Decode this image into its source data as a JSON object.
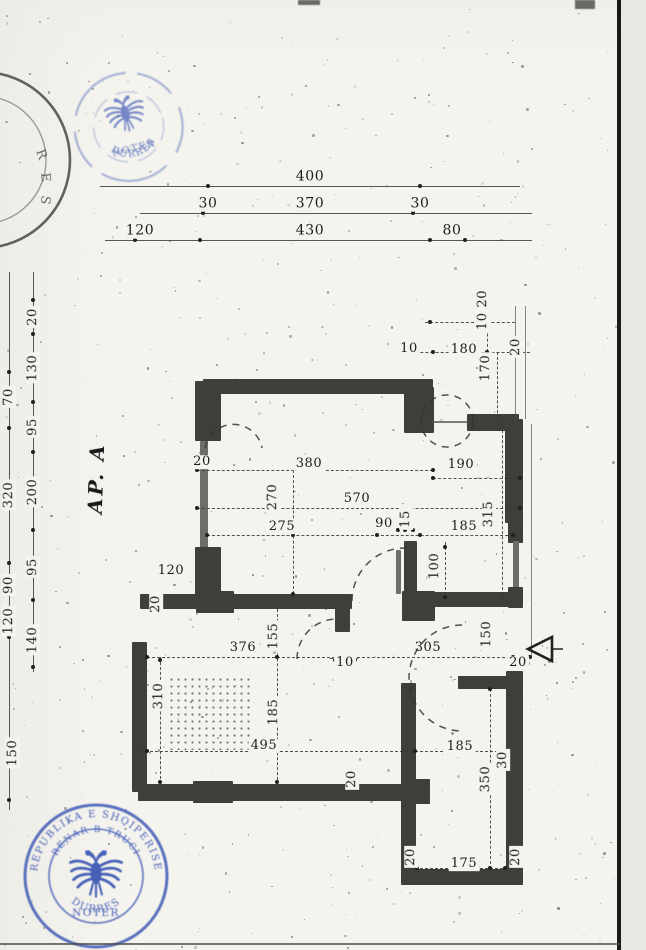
{
  "document": {
    "kind": "scanned notarized architectural floor plan",
    "apartment_label": "AP. A"
  },
  "colors": {
    "paper": "#f4f3ee",
    "ink": "#22211e",
    "wall": "#3f3e3b",
    "stamp_blue": "#3a55b4"
  },
  "stamps": {
    "top_round": {
      "line1": "NOTER",
      "line2": "DURRES"
    },
    "left_partial": {
      "letters": [
        "R",
        "E",
        "S"
      ]
    },
    "bottom_round": {
      "outer_text": "REPUBLIKA E SHQIPERISE",
      "mid_text": "RENAR B TRUCI",
      "line1": "NOTER",
      "line2": "DURRES"
    }
  },
  "dims": [
    {
      "id": "t400",
      "text": "400",
      "group": "top-row1"
    },
    {
      "id": "t30a",
      "text": "30",
      "group": "top-row2"
    },
    {
      "id": "t370",
      "text": "370",
      "group": "top-row2"
    },
    {
      "id": "t30b",
      "text": "30",
      "group": "top-row2"
    },
    {
      "id": "t120",
      "text": "120",
      "group": "top-row3"
    },
    {
      "id": "t430",
      "text": "430",
      "group": "top-row3"
    },
    {
      "id": "t80",
      "text": "80",
      "group": "top-row3"
    },
    {
      "id": "li20",
      "text": "20",
      "group": "left-inner"
    },
    {
      "id": "li130",
      "text": "130",
      "group": "left-inner"
    },
    {
      "id": "li95a",
      "text": "95",
      "group": "left-inner"
    },
    {
      "id": "li200",
      "text": "200",
      "group": "left-inner"
    },
    {
      "id": "li95b",
      "text": "95",
      "group": "left-inner"
    },
    {
      "id": "li140",
      "text": "140",
      "group": "left-inner"
    },
    {
      "id": "lo70",
      "text": "70",
      "group": "left-outer"
    },
    {
      "id": "lo320",
      "text": "320",
      "group": "left-outer"
    },
    {
      "id": "lo90",
      "text": "90",
      "group": "left-outer"
    },
    {
      "id": "lo120",
      "text": "120",
      "group": "left-outer"
    },
    {
      "id": "lo150",
      "text": "150",
      "group": "left-outer"
    },
    {
      "id": "d20a",
      "text": "20",
      "group": "plan"
    },
    {
      "id": "d380",
      "text": "380",
      "group": "plan"
    },
    {
      "id": "d570",
      "text": "570",
      "group": "plan"
    },
    {
      "id": "d270",
      "text": "270",
      "group": "plan"
    },
    {
      "id": "d275",
      "text": "275",
      "group": "plan"
    },
    {
      "id": "d90",
      "text": "90",
      "group": "plan"
    },
    {
      "id": "d15",
      "text": "15",
      "group": "plan"
    },
    {
      "id": "d185a",
      "text": "185",
      "group": "plan"
    },
    {
      "id": "d190",
      "text": "190",
      "group": "plan"
    },
    {
      "id": "d315",
      "text": "315",
      "group": "plan"
    },
    {
      "id": "d180",
      "text": "180",
      "group": "plan"
    },
    {
      "id": "d170",
      "text": "170",
      "group": "plan"
    },
    {
      "id": "d10a",
      "text": "10",
      "group": "plan"
    },
    {
      "id": "d1020",
      "text": "10 20",
      "group": "plan"
    },
    {
      "id": "d20b",
      "text": "20",
      "group": "plan"
    },
    {
      "id": "d100",
      "text": "100",
      "group": "plan"
    },
    {
      "id": "d20c",
      "text": "20",
      "group": "plan"
    },
    {
      "id": "d120b",
      "text": "120",
      "group": "plan"
    },
    {
      "id": "d376",
      "text": "376",
      "group": "plan"
    },
    {
      "id": "d155",
      "text": "155",
      "group": "plan"
    },
    {
      "id": "d10b",
      "text": "10",
      "group": "plan"
    },
    {
      "id": "d305",
      "text": "305",
      "group": "plan"
    },
    {
      "id": "d150b",
      "text": "150",
      "group": "plan"
    },
    {
      "id": "d20d",
      "text": "20",
      "group": "plan"
    },
    {
      "id": "d310",
      "text": "310",
      "group": "plan"
    },
    {
      "id": "d185b",
      "text": "185",
      "group": "plan"
    },
    {
      "id": "d495",
      "text": "495",
      "group": "plan"
    },
    {
      "id": "d185c",
      "text": "185",
      "group": "plan"
    },
    {
      "id": "d20e",
      "text": "20",
      "group": "plan"
    },
    {
      "id": "d350",
      "text": "350",
      "group": "plan"
    },
    {
      "id": "d30",
      "text": "30",
      "group": "plan"
    },
    {
      "id": "d175",
      "text": "175",
      "group": "plan"
    },
    {
      "id": "d20f",
      "text": "20",
      "group": "plan"
    },
    {
      "id": "d20g",
      "text": "20",
      "group": "plan"
    }
  ]
}
